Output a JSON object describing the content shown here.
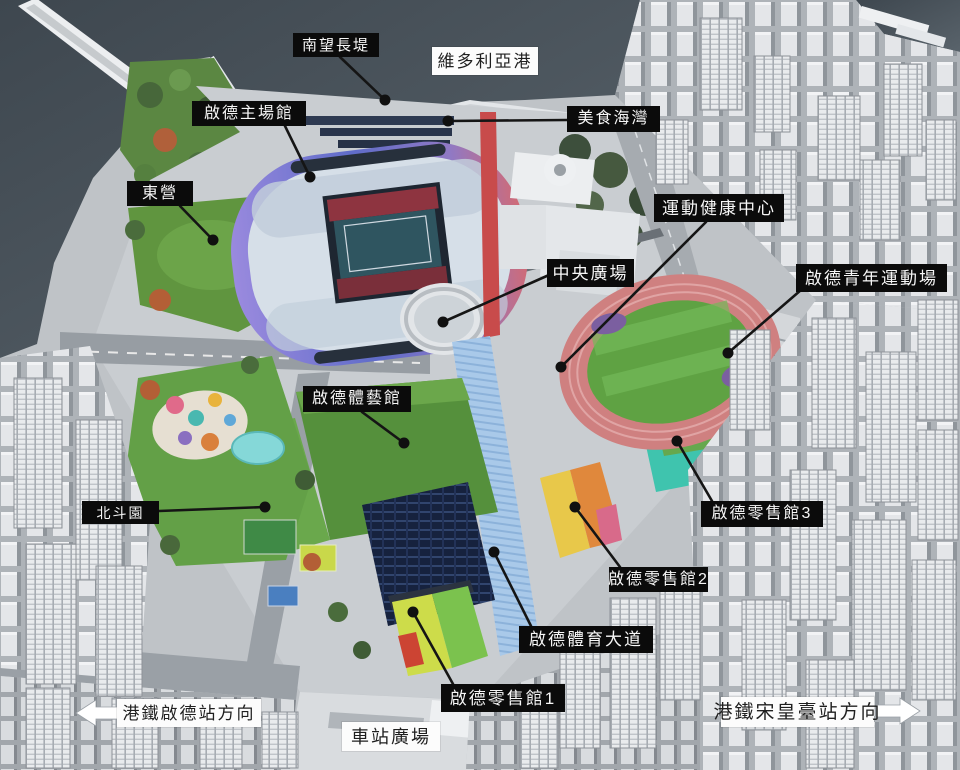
{
  "palette": {
    "label_dark_bg": "#0b0b0b",
    "label_dark_text": "#f6f6f6",
    "label_light_bg": "#fcfcfc",
    "label_light_text": "#1f1f1f",
    "leader_line": "#151515",
    "leader_dot": "#101010",
    "water": "#475058",
    "lawn_green": "#5f9a43",
    "track_pink": "#cf8080",
    "stadium_shell_purple": "#8f7fd6",
    "stadium_shell_pink": "#d26a74",
    "footbridge_blue": "#a9c9e9",
    "red_walkway": "#c84b4b",
    "retail_cyan": "#3fc4ae",
    "city_building": "#e4e6e9"
  },
  "labels": [
    {
      "id": "south-breakwater",
      "text": "南望長堤",
      "style": "dark",
      "box": {
        "x": 293,
        "y": 33,
        "w": 86,
        "h": 24
      },
      "leader": {
        "x1": 340,
        "y1": 57,
        "x2": 385,
        "y2": 100
      }
    },
    {
      "id": "victoria-harbour",
      "text": "維多利亞港",
      "style": "light",
      "box": {
        "x": 432,
        "y": 47,
        "w": 106,
        "h": 28
      }
    },
    {
      "id": "kai-tak-main-stadium",
      "text": "啟德主場館",
      "style": "dark",
      "box": {
        "x": 192,
        "y": 101,
        "w": 114,
        "h": 25
      },
      "leader": {
        "x1": 285,
        "y1": 126,
        "x2": 310,
        "y2": 177
      }
    },
    {
      "id": "food-bay",
      "text": "美食海灣",
      "style": "dark",
      "box": {
        "x": 567,
        "y": 106,
        "w": 93,
        "h": 26
      },
      "leader": {
        "x1": 567,
        "y1": 120,
        "x2": 448,
        "y2": 121
      }
    },
    {
      "id": "east-lawn",
      "text": "東營",
      "style": "dark",
      "box": {
        "x": 127,
        "y": 181,
        "w": 66,
        "h": 25
      },
      "leader": {
        "x1": 180,
        "y1": 206,
        "x2": 213,
        "y2": 240
      }
    },
    {
      "id": "sports-health-centre",
      "text": "運動健康中心",
      "style": "dark",
      "box": {
        "x": 654,
        "y": 194,
        "w": 130,
        "h": 28
      },
      "leader": {
        "x1": 706,
        "y1": 222,
        "x2": 561,
        "y2": 367
      }
    },
    {
      "id": "central-square",
      "text": "中央廣場",
      "style": "dark",
      "box": {
        "x": 547,
        "y": 259,
        "w": 87,
        "h": 28
      },
      "leader": {
        "x1": 549,
        "y1": 275,
        "x2": 443,
        "y2": 322
      }
    },
    {
      "id": "youth-sports-ground",
      "text": "啟德青年運動場",
      "style": "dark",
      "box": {
        "x": 796,
        "y": 264,
        "w": 151,
        "h": 28
      },
      "leader": {
        "x1": 801,
        "y1": 290,
        "x2": 728,
        "y2": 353
      }
    },
    {
      "id": "indoor-sports-centre",
      "text": "啟德體藝館",
      "style": "dark",
      "box": {
        "x": 303,
        "y": 386,
        "w": 108,
        "h": 26
      },
      "leader": {
        "x1": 362,
        "y1": 412,
        "x2": 404,
        "y2": 443
      }
    },
    {
      "id": "north-plaza",
      "text": "北斗園",
      "style": "dark",
      "box": {
        "x": 82,
        "y": 501,
        "w": 77,
        "h": 23
      },
      "leader": {
        "x1": 159,
        "y1": 511,
        "x2": 265,
        "y2": 507
      }
    },
    {
      "id": "retail-hall-3",
      "text": "啟德零售館3",
      "style": "dark",
      "box": {
        "x": 701,
        "y": 501,
        "w": 122,
        "h": 26
      },
      "leader": {
        "x1": 712,
        "y1": 501,
        "x2": 677,
        "y2": 441
      }
    },
    {
      "id": "retail-hall-2",
      "text": "啟德零售館2",
      "style": "dark",
      "box": {
        "x": 609,
        "y": 567,
        "w": 99,
        "h": 25
      },
      "leader": {
        "x1": 620,
        "y1": 567,
        "x2": 575,
        "y2": 507
      }
    },
    {
      "id": "sports-avenue",
      "text": "啟德體育大道",
      "style": "dark",
      "box": {
        "x": 519,
        "y": 626,
        "w": 134,
        "h": 27
      },
      "leader": {
        "x1": 531,
        "y1": 626,
        "x2": 494,
        "y2": 552
      }
    },
    {
      "id": "retail-hall-1",
      "text": "啟德零售館1",
      "style": "dark",
      "box": {
        "x": 441,
        "y": 684,
        "w": 124,
        "h": 28
      },
      "leader": {
        "x1": 453,
        "y1": 684,
        "x2": 413,
        "y2": 612
      }
    },
    {
      "id": "mtr-kai-tak-direction",
      "text": "港鐵啟德站方向",
      "style": "light",
      "box": {
        "x": 117,
        "y": 699,
        "w": 144,
        "h": 28
      }
    },
    {
      "id": "station-square",
      "text": "車站廣場",
      "style": "light",
      "box": {
        "x": 342,
        "y": 722,
        "w": 98,
        "h": 29
      }
    },
    {
      "id": "mtr-sung-wong-toi-direction",
      "text": "港鐵宋皇臺站方向",
      "style": "light",
      "box": {
        "x": 721,
        "y": 697,
        "w": 153,
        "h": 30
      }
    }
  ],
  "arrows": [
    {
      "id": "mtr-kai-tak-arrow",
      "direction": "left",
      "tip_x": 76,
      "tip_y": 713
    },
    {
      "id": "mtr-sung-wong-toi-arrow",
      "direction": "right",
      "tip_x": 920,
      "tip_y": 711
    }
  ]
}
